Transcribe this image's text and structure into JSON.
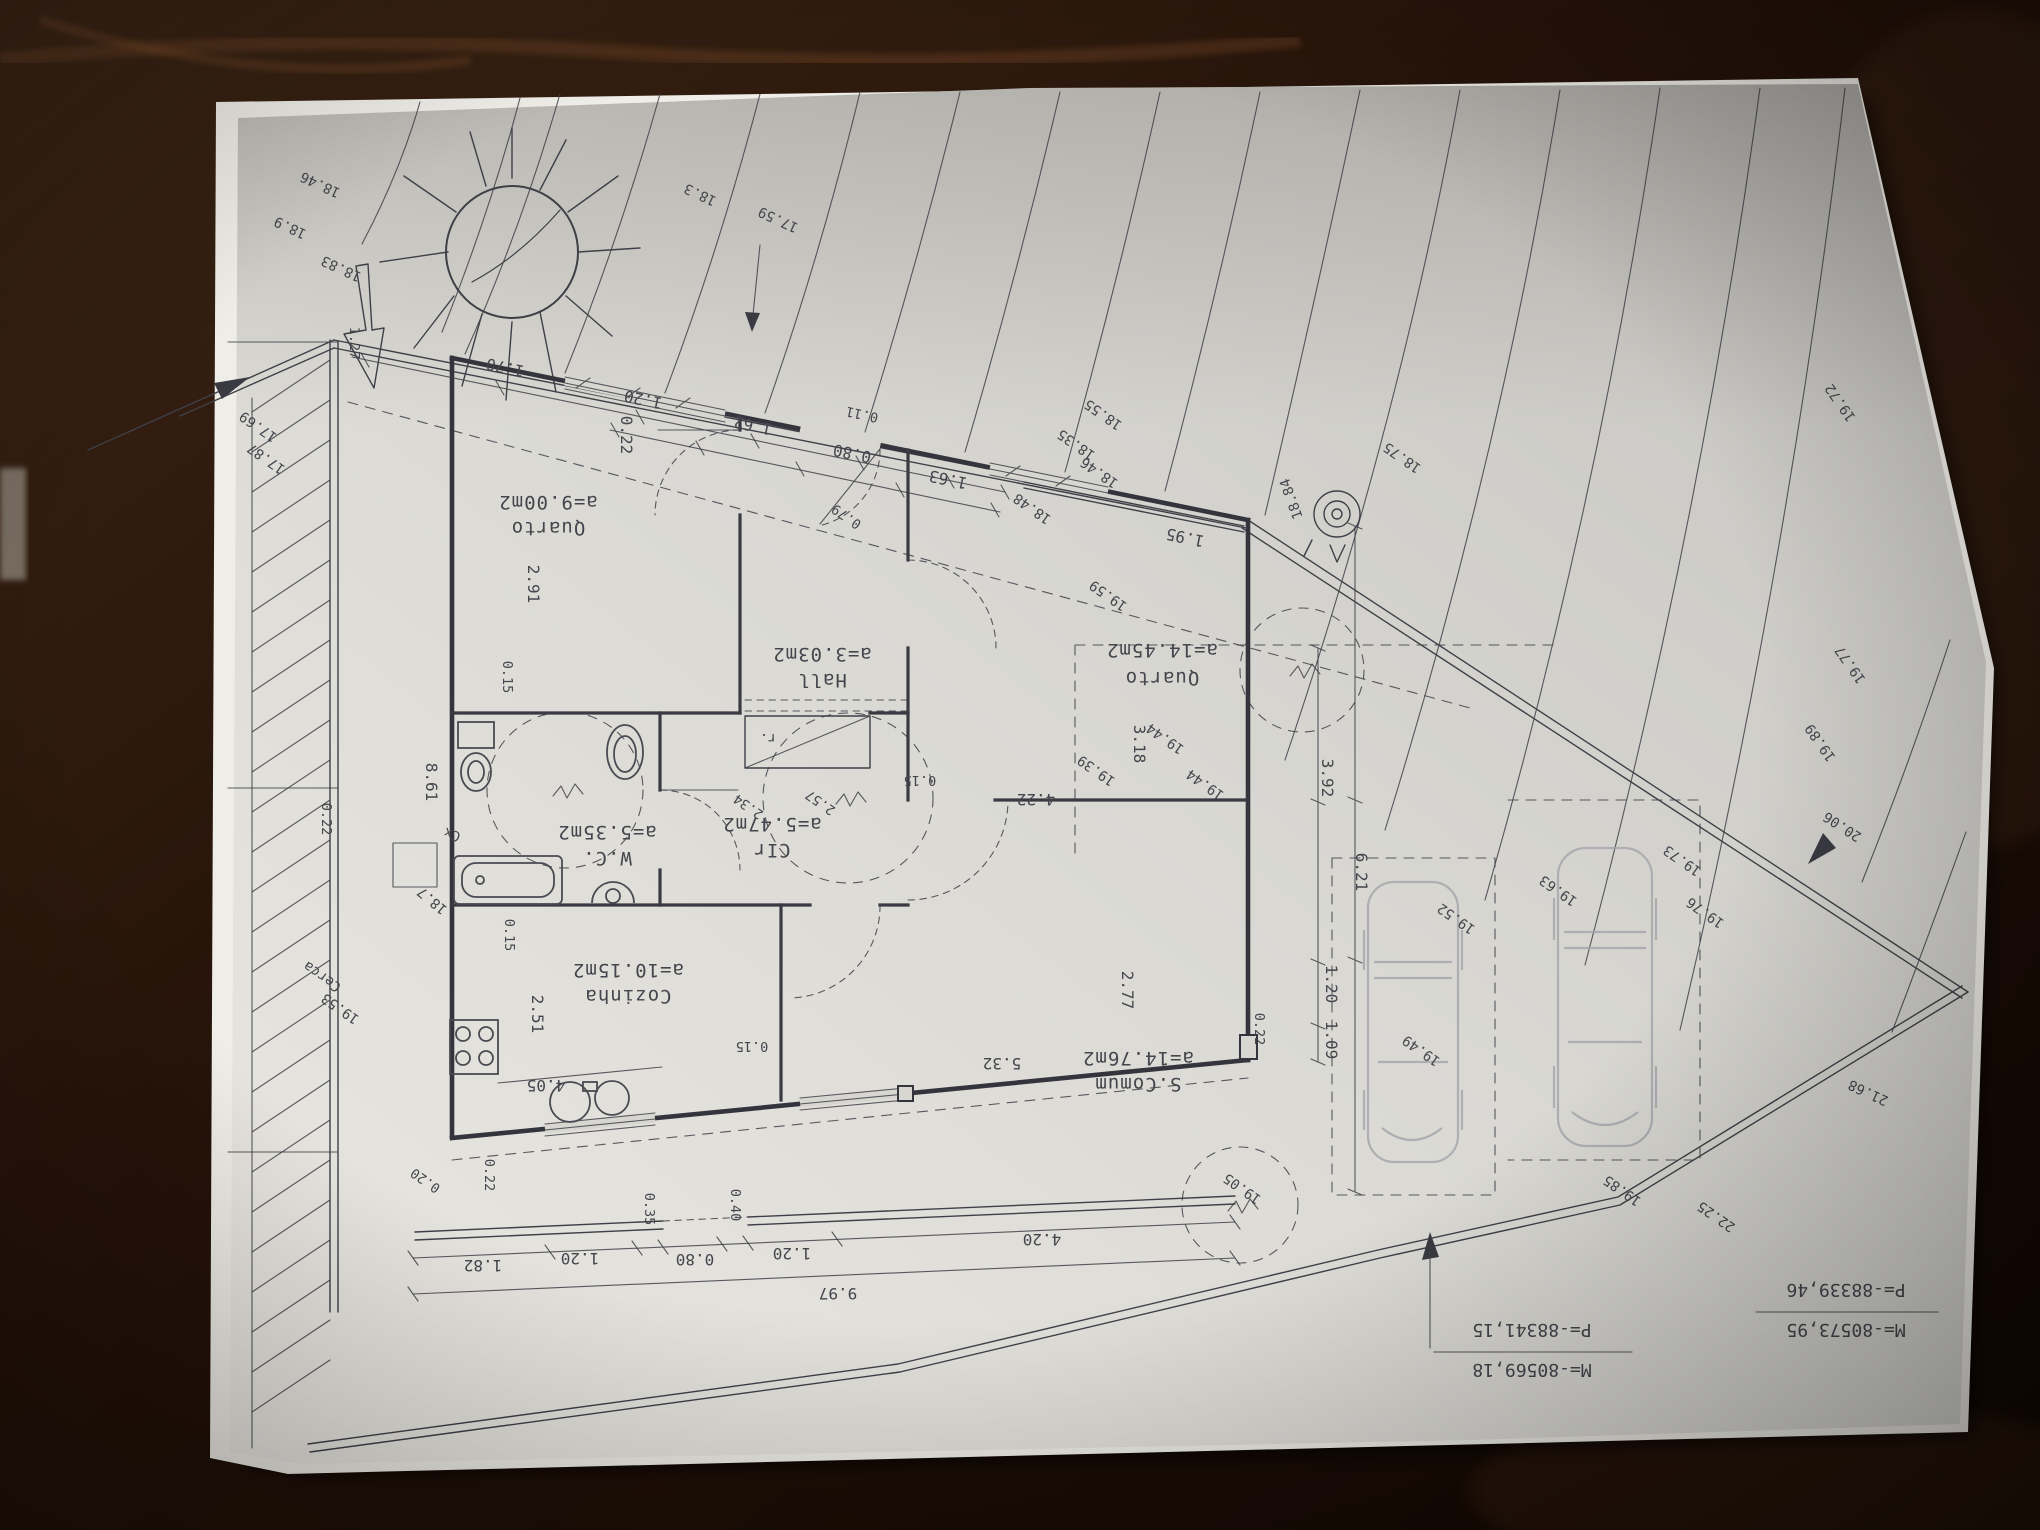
{
  "rooms": [
    {
      "name": "Quarto",
      "area": "a=9.00m2"
    },
    {
      "name": "Hall",
      "area": "a=3.03m2"
    },
    {
      "name": "Quarto",
      "area": "a=14.45m2"
    },
    {
      "name": "W.C.",
      "area": "a=5.35m2"
    },
    {
      "name": "CIr",
      "area": "a=5.47m2"
    },
    {
      "name": "Cozinha",
      "area": "a=10.15m2"
    },
    {
      "name": "S.Comum",
      "area": "a=14.76m2"
    }
  ],
  "dimensions": {
    "top": [
      "1.70",
      "1.20",
      "1.62",
      "0.11",
      "0.80",
      "1.63",
      "1.95",
      "0.22",
      "0.79",
      "1.27"
    ],
    "interior": [
      "2.91",
      "0.15",
      "0.15",
      "0.15",
      "3.18",
      "4.22",
      "2.77",
      "5.32",
      "2.51",
      "4.05",
      "2.57",
      "2.34",
      "0.15"
    ],
    "right": [
      "3.92",
      "6.21",
      "1.20",
      "1.09",
      "0.22"
    ],
    "bottom": [
      "1.82",
      "1.20",
      "0.35",
      "0.80",
      "0.40",
      "1.20",
      "4.20",
      "9.97",
      "0.22",
      "0.20",
      "0.22",
      "8.61"
    ]
  },
  "elevations": {
    "corner": [
      "18.46",
      "18.9",
      "18.83"
    ],
    "west": [
      "17.69",
      "17.87",
      "19.53"
    ],
    "contours": [
      "18.3",
      "17.59",
      "18.55",
      "18.35",
      "18.46",
      "18.48",
      "18.75",
      "18.84",
      "19.72",
      "19.77",
      "19.89"
    ],
    "parking": [
      "19.59",
      "19.44",
      "19.44",
      "19.39",
      "19.52",
      "19.49",
      "19.63",
      "19.73",
      "19.76",
      "19.05"
    ],
    "road": [
      "19.85",
      "22.25",
      "21.68",
      "20.06"
    ],
    "utility": [
      "18.7"
    ]
  },
  "annotations": {
    "cerca": "Cerca",
    "cx": "Cx",
    "closet": "r."
  },
  "survey_points": [
    {
      "m": "M=-80569,18",
      "p": "P=-88341,15"
    },
    {
      "m": "M=-80573,95",
      "p": "P=-88339,46"
    }
  ],
  "symbols": [
    "sun-symbol",
    "north-arrow",
    "survey-marker",
    "tree-symbol",
    "car-sketch"
  ]
}
